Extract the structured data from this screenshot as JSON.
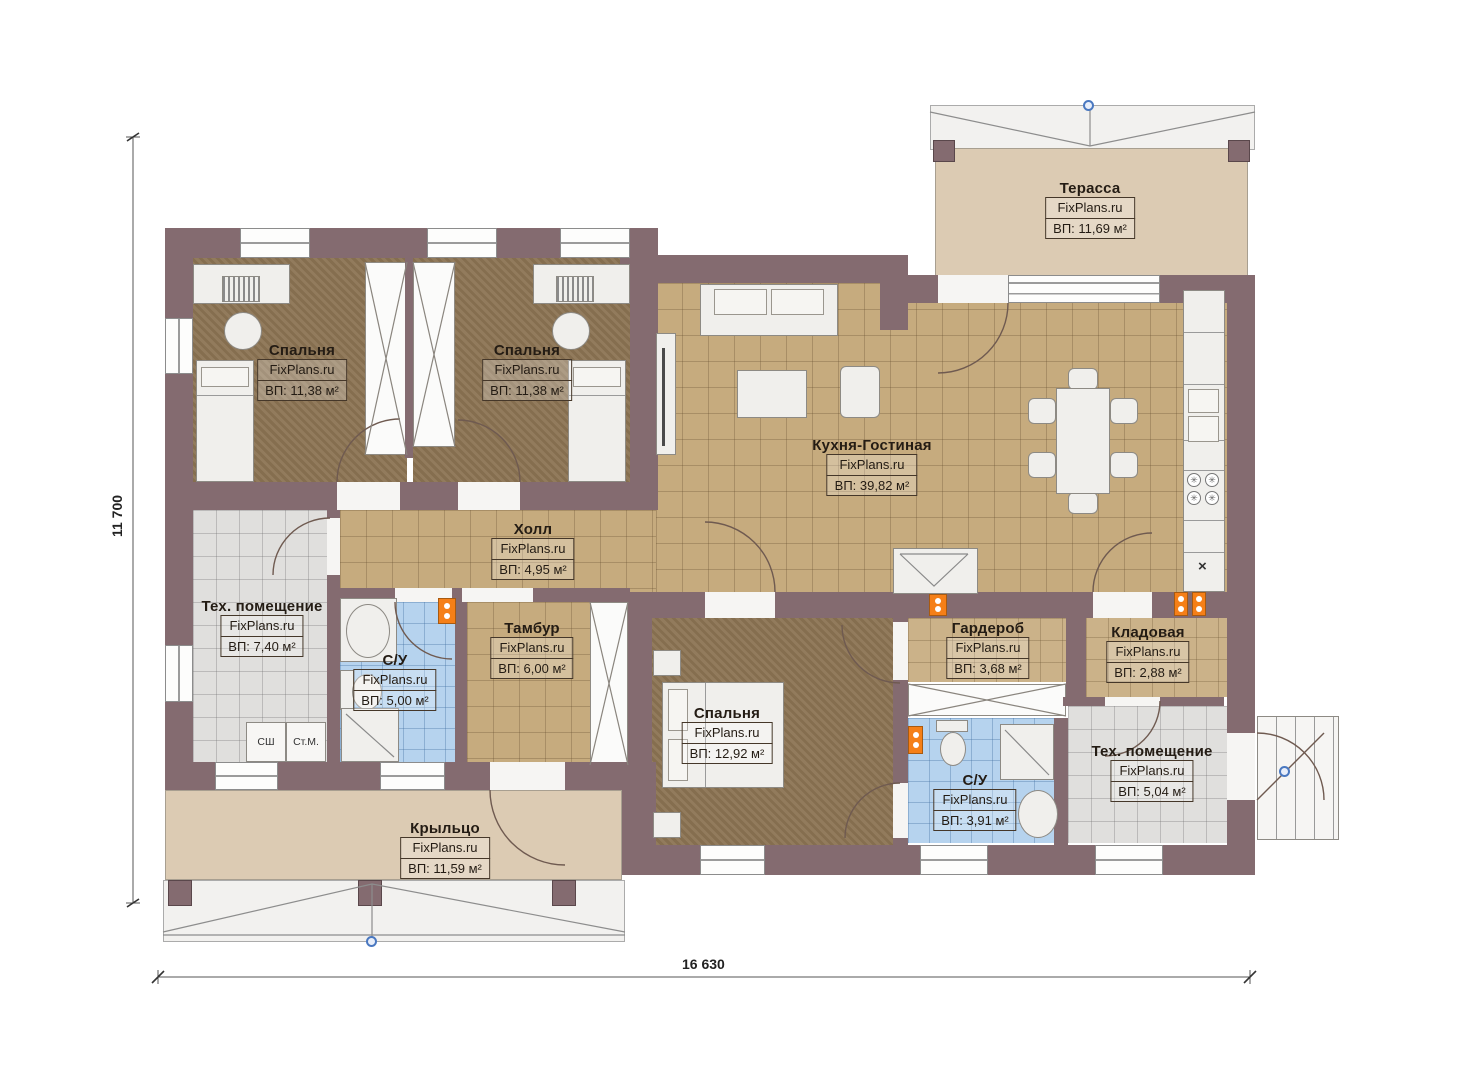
{
  "brand": "FixPlans.ru",
  "dimensions": {
    "height_label": "11 700",
    "width_label": "16 630"
  },
  "rooms": [
    {
      "name": "Терасса",
      "brand": "FixPlans.ru",
      "area": "ВП: 11,69 м²"
    },
    {
      "name": "Спальня",
      "brand": "FixPlans.ru",
      "area": "ВП: 11,38 м²"
    },
    {
      "name": "Спальня",
      "brand": "FixPlans.ru",
      "area": "ВП: 11,38 м²"
    },
    {
      "name": "Кухня-Гостиная",
      "brand": "FixPlans.ru",
      "area": "ВП: 39,82 м²"
    },
    {
      "name": "Холл",
      "brand": "FixPlans.ru",
      "area": "ВП: 4,95 м²"
    },
    {
      "name": "Тех. помещение",
      "brand": "FixPlans.ru",
      "area": "ВП: 7,40 м²"
    },
    {
      "name": "С/У",
      "brand": "FixPlans.ru",
      "area": "ВП: 5,00 м²"
    },
    {
      "name": "Тамбур",
      "brand": "FixPlans.ru",
      "area": "ВП: 6,00 м²"
    },
    {
      "name": "Спальня",
      "brand": "FixPlans.ru",
      "area": "ВП: 12,92 м²"
    },
    {
      "name": "Гардероб",
      "brand": "FixPlans.ru",
      "area": "ВП: 3,68 м²"
    },
    {
      "name": "Кладовая",
      "brand": "FixPlans.ru",
      "area": "ВП: 2,88 м²"
    },
    {
      "name": "С/У",
      "brand": "FixPlans.ru",
      "area": "ВП: 3,91 м²"
    },
    {
      "name": "Тех. помещение",
      "brand": "FixPlans.ru",
      "area": "ВП: 5,04 м²"
    },
    {
      "name": "Крыльцо",
      "brand": "FixPlans.ru",
      "area": "ВП: 11,59 м²"
    }
  ],
  "appliances": {
    "dryer_label": "СШ",
    "washer_label": "Ст.М."
  },
  "marks": {
    "cabinet_x": "×"
  },
  "colors": {
    "wall": "#846b70",
    "bedroom_floor": "#8e7656",
    "tile_floor": "#c6ab7e",
    "bath_floor": "#b6d3ee",
    "tech_floor": "#e0dfdd",
    "terrace_floor": "#dccbb3",
    "radiator": "#f57f17"
  }
}
